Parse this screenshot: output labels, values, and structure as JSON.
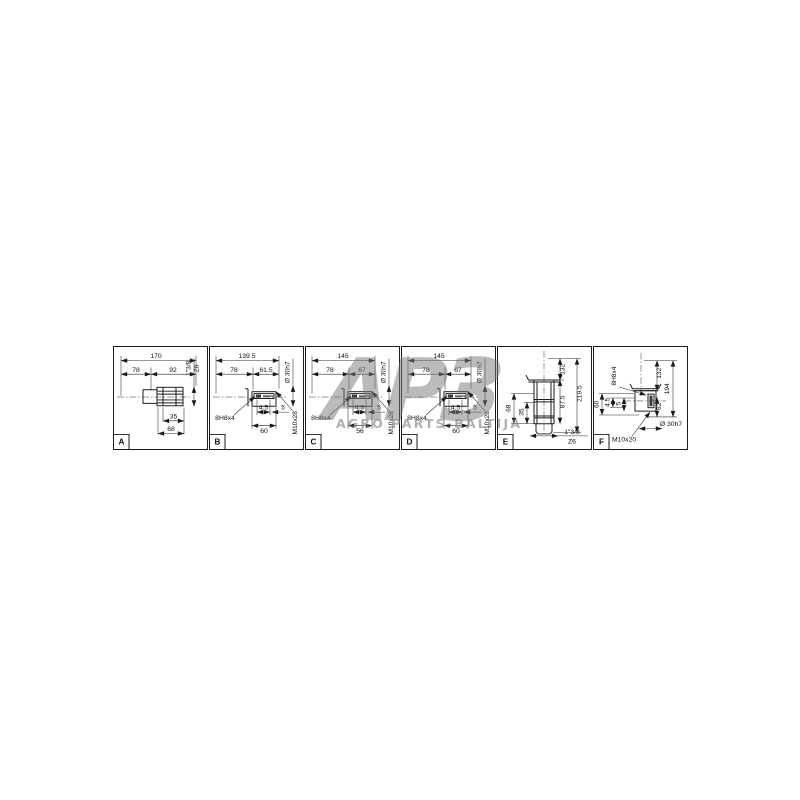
{
  "watermark": {
    "big": "АРЗ",
    "sub": "AGRO PARTS-BALTIJA"
  },
  "panels": [
    {
      "letter": "A",
      "dim_total": "170",
      "dim_left": "78",
      "dim_right": "92",
      "spline": "1\"3/8",
      "spline_teeth": "Z6",
      "dim_b1": "35",
      "dim_b2": "68"
    },
    {
      "letter": "B",
      "dim_total": "139.5",
      "dim_left": "78",
      "dim_right": "61.5",
      "bore": "Ø 30h7",
      "keyway": "8H8x4",
      "key_depth": "4.5",
      "key_offset": "5",
      "dim_width": "60",
      "thread": "M10x28"
    },
    {
      "letter": "C",
      "dim_total": "145",
      "dim_left": "78",
      "dim_right": "67",
      "bore": "Ø 30h7",
      "keyway": "8H8x4",
      "key_depth": "4.5",
      "key_offset": "5",
      "dim_width": "56",
      "thread": "M10x28"
    },
    {
      "letter": "D",
      "dim_total": "145",
      "dim_left": "78",
      "dim_right": "67",
      "bore": "Ø 30h7",
      "keyway": "8H8x4",
      "key_depth": "4.5",
      "key_offset": "5",
      "dim_width": "60",
      "thread": "M10x28"
    },
    {
      "letter": "E",
      "dim_r1": "132",
      "dim_r2": "87.5",
      "dim_r3": "219.5",
      "dim_l1": "68",
      "dim_l2": "35",
      "spline": "1\"3/8",
      "spline_teeth": "Z6"
    },
    {
      "letter": "F",
      "keyway": "8H8x4",
      "dim_l1": "60",
      "dim_l2": "4.5",
      "dim_l3": "5",
      "dim_r1": "132",
      "dim_r2": "194",
      "dim_r3": "62",
      "bore": "Ø 30h7",
      "thread": "M10x20"
    }
  ]
}
